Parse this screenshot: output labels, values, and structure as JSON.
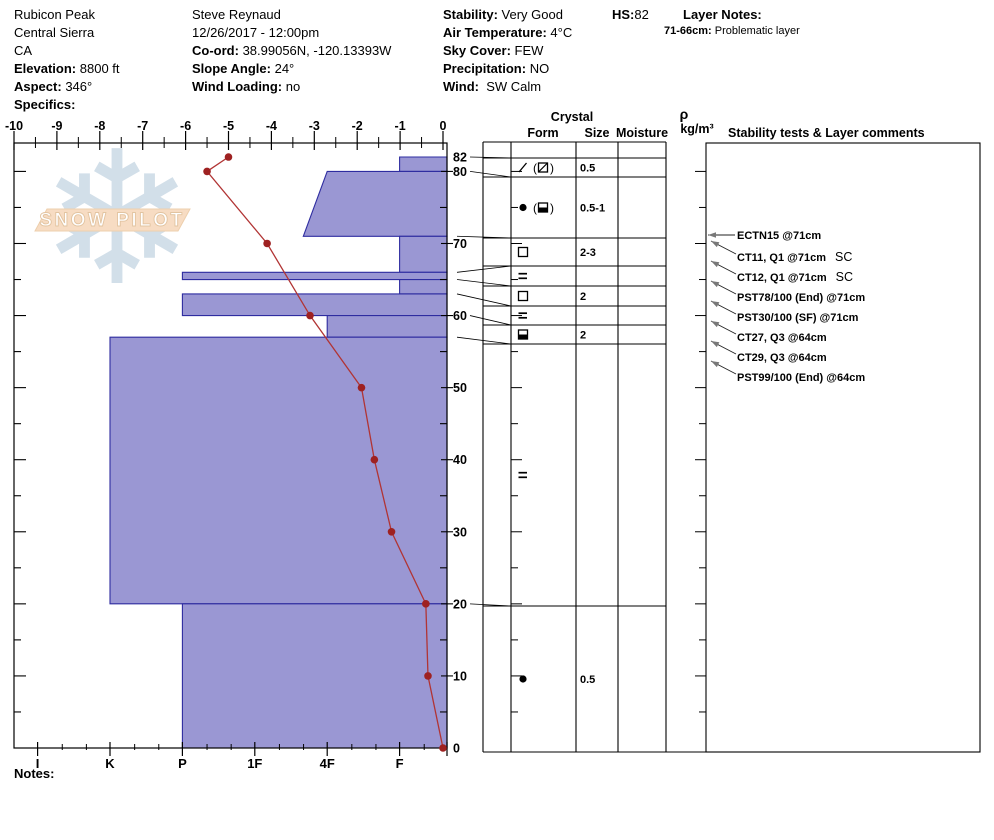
{
  "header": {
    "location": {
      "line1": "Rubicon Peak",
      "line2": "Central Sierra",
      "line3": "CA",
      "elevation_label": "Elevation:",
      "elevation": "8800 ft",
      "aspect_label": "Aspect:",
      "aspect": "346°",
      "specifics_label": "Specifics:"
    },
    "observer": {
      "name": "Steve Reynaud",
      "datetime": "12/26/2017 - 12:00pm",
      "coord_label": "Co-ord:",
      "coord": "38.99056N, -120.13393W",
      "slope_label": "Slope Angle:",
      "slope": "24°",
      "wind_loading_label": "Wind Loading:",
      "wind_loading": "no"
    },
    "conditions": {
      "stability_label": "Stability:",
      "stability": "Very Good",
      "air_temp_label": "Air Temperature:",
      "air_temp": "4°C",
      "sky_label": "Sky Cover:",
      "sky": "FEW",
      "precip_label": "Precipitation:",
      "precip": "NO",
      "wind_label": "Wind:",
      "wind": "SW Calm"
    },
    "hs_label": "HS:",
    "hs": "82",
    "layer_notes_label": "Layer Notes:",
    "layer_note_depth": "71-66cm:",
    "layer_note_text": "Problematic layer"
  },
  "notes_label": "Notes:",
  "watermark": {
    "text": "SNOW PILOT",
    "snowflake_icon": "snowflake-icon",
    "snowflake_color": "#d2dfe9",
    "banner_fill": "#f7dcc3",
    "banner_stroke": "#edcfad",
    "text_fill": "#ffffff",
    "text_stroke": "#e2c4a1"
  },
  "chart_data": {
    "type": "snow-pit-profile",
    "depth_axis": {
      "unit": "cm",
      "max": 82,
      "labels": [
        82,
        80,
        70,
        60,
        50,
        40,
        30,
        20,
        10,
        0
      ]
    },
    "temp_axis": {
      "unit": "°C",
      "labels": [
        -10,
        -9,
        -8,
        -7,
        -6,
        -5,
        -4,
        -3,
        -2,
        -1,
        0
      ]
    },
    "hardness_axis": {
      "labels": [
        "I",
        "K",
        "P",
        "1F",
        "4F",
        "F"
      ]
    },
    "layers": [
      {
        "top": 82,
        "bottom": 80,
        "hardness": "F",
        "form": "slash",
        "form2": "square-slash",
        "size": "0.5",
        "row": [
          158,
          177
        ]
      },
      {
        "top": 80,
        "bottom": 71,
        "hardness": "4F",
        "hardness_bottom": "4F+",
        "form": "circle",
        "form2": "square-half",
        "size": "0.5-1",
        "row": [
          177,
          238
        ]
      },
      {
        "top": 71,
        "bottom": 66,
        "hardness": "F",
        "form": "square",
        "size": "2-3",
        "row": [
          238,
          266
        ]
      },
      {
        "top": 66,
        "bottom": 65,
        "hardness": "P",
        "form": "equals",
        "size": "",
        "row": [
          266,
          286
        ]
      },
      {
        "top": 65,
        "bottom": 63,
        "hardness": "F",
        "form": "square",
        "size": "2",
        "row": [
          286,
          306
        ]
      },
      {
        "top": 63,
        "bottom": 60,
        "hardness": "P",
        "form": "equals",
        "size": "",
        "row": [
          306,
          325
        ]
      },
      {
        "top": 60,
        "bottom": 57,
        "hardness": "4F",
        "form": "square-half",
        "size": "2",
        "row": [
          325,
          344
        ]
      },
      {
        "top": 57,
        "bottom": 20,
        "hardness": "K",
        "form": "equals",
        "size": "",
        "row": [
          344,
          606
        ]
      },
      {
        "top": 20,
        "bottom": 0,
        "hardness": "P",
        "form": "circle",
        "size": "0.5",
        "row": [
          606,
          752
        ]
      }
    ],
    "temperature_series": [
      [
        82,
        -5
      ],
      [
        80,
        -5.5
      ],
      [
        70,
        -4.1
      ],
      [
        60,
        -3.1
      ],
      [
        50,
        -1.9
      ],
      [
        40,
        -1.6
      ],
      [
        30,
        -1.2
      ],
      [
        20,
        -0.4
      ],
      [
        10,
        -0.35
      ],
      [
        0,
        0
      ]
    ],
    "connectors": [
      {
        "depth": 82,
        "row_y": 158,
        "start_x": 470
      },
      {
        "depth": 80,
        "row_y": 177,
        "start_x": 470
      },
      {
        "depth": 71,
        "row_y": 238,
        "start_x": 457
      },
      {
        "depth": 66,
        "row_y": 266,
        "start_x": 457
      },
      {
        "depth": 65,
        "row_y": 286,
        "start_x": 457
      },
      {
        "depth": 63,
        "row_y": 306,
        "start_x": 457
      },
      {
        "depth": 60,
        "row_y": 325,
        "start_x": 470
      },
      {
        "depth": 57,
        "row_y": 344,
        "start_x": 457
      },
      {
        "depth": 20,
        "row_y": 606,
        "start_x": 470
      }
    ],
    "table_headers": {
      "crystal": "Crystal",
      "form": "Form",
      "size": "Size",
      "moisture": "Moisture",
      "rho": "ρ",
      "rho_units": "kg/m³",
      "stability": "Stability tests & Layer comments"
    },
    "stability_tests": [
      {
        "label": "ECTN15 @71cm",
        "suffix": "",
        "y": 235,
        "horizontal": true
      },
      {
        "label": "CT11, Q1 @71cm",
        "suffix": "SC",
        "y": 257
      },
      {
        "label": "CT12, Q1 @71cm",
        "suffix": "SC",
        "y": 277
      },
      {
        "label": "PST78/100 (End) @71cm",
        "suffix": "",
        "y": 297
      },
      {
        "label": "PST30/100 (SF) @71cm",
        "suffix": "",
        "y": 317
      },
      {
        "label": "CT27, Q3 @64cm",
        "suffix": "",
        "y": 337
      },
      {
        "label": "CT29, Q3 @64cm",
        "suffix": "",
        "y": 357
      },
      {
        "label": "PST99/100 (End) @64cm",
        "suffix": "",
        "y": 377
      }
    ],
    "colors": {
      "layer_fill": "#9a97d3",
      "layer_stroke": "#2e2ca0",
      "temp_line": "#b13434",
      "temp_dot": "#9e2121",
      "axis": "#000000",
      "arrow_head": "#787878"
    }
  }
}
